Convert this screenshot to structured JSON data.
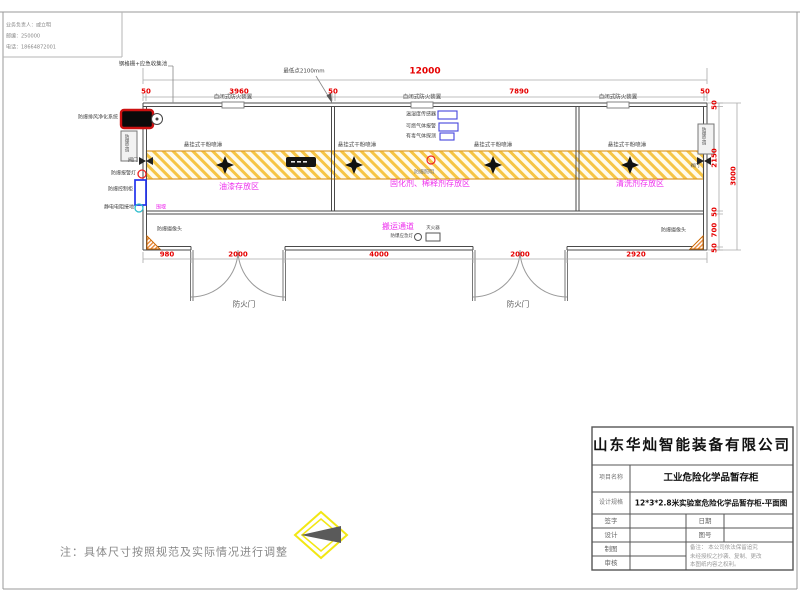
{
  "contact": {
    "line1": "业务负责人：戚立明",
    "line2": "邮编：250000",
    "line3": "电话：18664872001"
  },
  "dimensions": {
    "total_width": "12000",
    "top": [
      "50",
      "3960",
      "50",
      "7890",
      "50"
    ],
    "bottom": [
      "980",
      "2000",
      "4000",
      "2000",
      "2920"
    ],
    "right": [
      "50",
      "2150",
      "50",
      "700",
      "50"
    ],
    "total_height": "3000"
  },
  "plan": {
    "grating": "钢格栅+应急收集池",
    "lowest_point": "最低点2100mm",
    "fire_damper": "自闭式防火装置",
    "spray": "悬挂式干粉喷淋",
    "sensor_temp": "温湿度传感器",
    "sensor_gas": "可燃气体报警",
    "sensor_toxic": "有毒气体探测",
    "exhaust": "防爆排风净化系统",
    "ac": "防爆空调",
    "valve": "阀门",
    "alarm_light": "防爆报警灯",
    "control_cabinet": "防爆控制柜",
    "static_ground": "静电电阻接地",
    "camera": "防爆摄像头",
    "lighting": "防爆照明",
    "bund": "围堰",
    "emergency_light": "防爆应急灯",
    "extinguisher": "灭火器",
    "fire_door": "防火门",
    "zone_paint": "油漆存放区",
    "zone_curing": "固化剂、稀释剂存放区",
    "zone_cleaning": "清洗剂存放区",
    "channel": "搬运通道"
  },
  "title_block": {
    "company": "山东华灿智能装备有限公司",
    "project_label": "项目名称",
    "project_value": "工业危险化学品暂存柜",
    "spec_label": "设计规格",
    "spec_value": "12*3*2.8米实验室危险化学品暂存柜-平面图",
    "sign": "签字",
    "date": "日期",
    "design": "设计",
    "drawing_no": "图号",
    "draft": "制图",
    "review": "审核",
    "remark": "备注：  本公司依法保留追究\n未经授权之抄袭、复制、更改\n本图纸内容之权利。"
  },
  "note": "注：具体尺寸按照规范及实际情况进行调整",
  "colors": {
    "dimension": "#e60000",
    "zone_label": "#ee30ee",
    "hatch": "#f6c545",
    "logo_yellow": "#f2e713"
  }
}
